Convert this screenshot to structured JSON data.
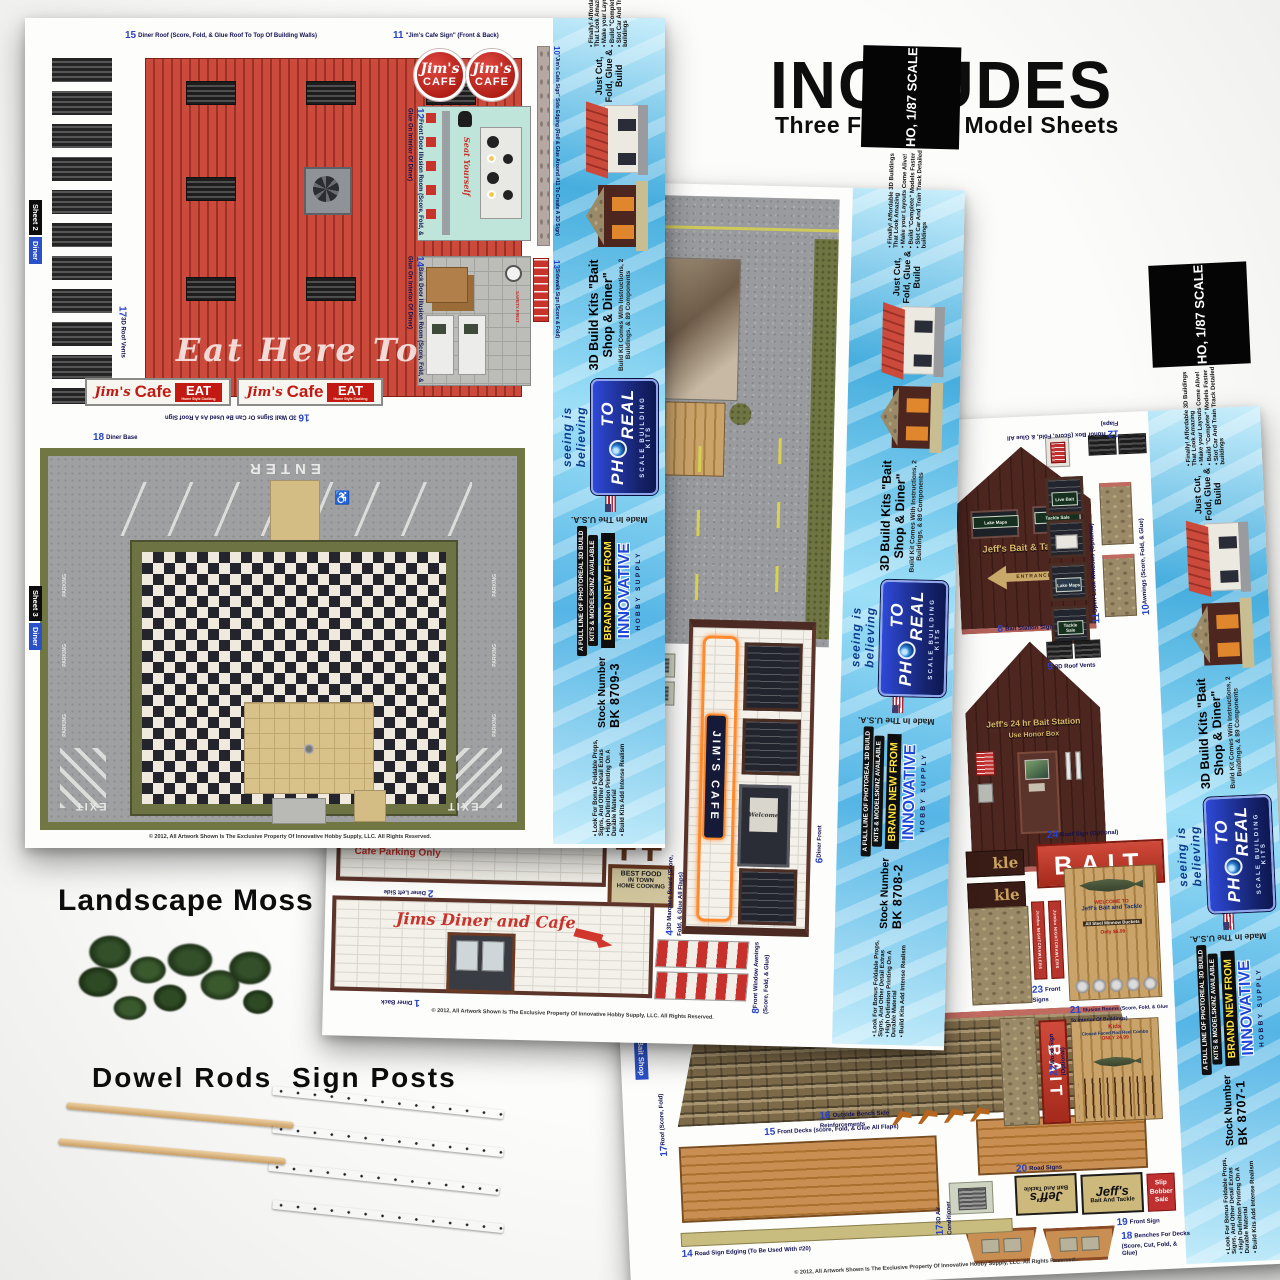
{
  "header": {
    "title": "INCLUDES",
    "subtitle": "Three Flexstock Model Sheets"
  },
  "extras": {
    "moss_label": "Landscape Moss",
    "dowel_label": "Dowel Rods",
    "signpost_label": "Sign Posts"
  },
  "copyright": "© 2012, All Artwork Shown Is The Exclusive Property Of Innovative Hobby Supply, LLC. All Rights Reserved.",
  "colors": {
    "spine_blue": "#55b5e5",
    "brand_yellow": "#ffe33c",
    "bait_red": "#c0392b",
    "roof_red": "#cb4a3b"
  },
  "spine": {
    "scale": "HO, 1/87 SCALE",
    "bullets_top": [
      "Finally! Affordable 3D Buildings That Look Amazing",
      "Make your Layouts Come Alive!",
      "Build \"Complete\" Models Faster",
      "Slot Car And Train Track Detailed buildings"
    ],
    "just_cut": "Just Cut, Fold, Glue & Build",
    "kit_title": "3D Build Kits  \"Bait Shop & Diner\"",
    "kit_sub": "Build Kit Comes With Instructions, 2 Buildings, & 89 Components",
    "logo_p1": "PH",
    "logo_p2": "TO REAL",
    "logo_sub": "SCALE BUILDING KITS",
    "tagline": "seeing is believing",
    "brand_new": "BRAND NEW FROM",
    "brand_name": "INNOVATIVE",
    "brand_sub": "HOBBY SUPPLY",
    "full_line1": "A FULL LINE OF PHOTOREAL 3D BUILD",
    "full_line2": "KITS & MODELSKINZ AVAILABLE",
    "made_in": "Made In The U.S.A.",
    "stock_label": "Stock Number",
    "bullets_bottom": [
      "Look For Bonus Foldable Props, Signs, And Other Detail Extras",
      "High Definition Printing On A Durable Material",
      "Build Kits Add Intense Realism"
    ]
  },
  "stock": {
    "left": "BK 8709-3",
    "middle": "BK 8708-2",
    "right": "BK 8707-1"
  },
  "left_sheet": {
    "tab_top_line1": "Sheet 2",
    "tab_top_line2": "Diner",
    "tab_bottom_line1": "Sheet 3",
    "tab_bottom_line2": "Diner",
    "p15_num": "15",
    "p15": "Diner Roof (Score, Fold, & Glue Roof To Top Of Building Walls)",
    "p11_num": "11",
    "p11": "\"Jim's Cafe Sign\" (Front & Back)",
    "p10_num": "10",
    "p10": "\"Jim's Cafe Sign\" Side Edging (Roll & Glue Around #11 To Create A 3D Sign)",
    "p12_num": "12",
    "p12": "Front Door Illusion Room (Score, Fold, & Glue On Interior Of Diner)",
    "p14_num": "14",
    "p14": "Back Door Illusion Room (Score, Fold, & Glue On Interior Of Diner)",
    "p13_num": "13",
    "p13": "Sidewalk Sign (Score & Fold)",
    "p17_num": "17",
    "p17": "3D Roof Vents",
    "p16_num": "16",
    "p16": "3D Wall Signs Or Can Be Used As A Roof Sign",
    "p18_num": "18",
    "p18": "Diner Base",
    "roof_script": "Eat Here Today",
    "cafe_sign_script": "Jim's",
    "cafe_sign_word": "CAFE",
    "wall_sign_script": "Jim's",
    "wall_sign_word": "Cafe",
    "wall_sign_eat": "EAT",
    "wall_sign_sub": "Home Style Cooking",
    "seat_yourself": "Seat Yourself",
    "safety": "SAFETY FIRST",
    "enter": "ENTER",
    "exit": "EXIT",
    "parking": "PARKING",
    "handicap": "♿"
  },
  "mid_sheet": {
    "p6_num": "6",
    "p6": "Diner Front",
    "p5_num": "5",
    "p5": "Air Conditioner (Score, Fold, & Glue Flaps)",
    "p4_num": "4",
    "p4": "3D Marquee Board (Score, Fold, & Glue All Flaps)",
    "p8_num": "8",
    "p8": "Front Window Awnings (Score, Fold, & Glue)",
    "p2_num": "2",
    "p2": "Diner Left Side",
    "p1_num": "1",
    "p1": "Diner Back",
    "neon_sign": "JIM'S CAFE",
    "welcome": "Welcome",
    "best1": "BEST FOOD",
    "best2": "IN TOWN",
    "best3": "HOME COOKING",
    "cafe_parking": "Cafe Parking Only",
    "back_script": "Jims Diner and Cafe"
  },
  "right_sheet": {
    "tab": "Bait Shop",
    "p12_num": "12",
    "p12": "Honor Box (Score, Fold, & Glue All Flaps)",
    "p11_num": "11",
    "p11": "Open-Look Windows (Optional)",
    "p10_num": "10",
    "p10": "Awnings (Score, Fold, & Glue)",
    "p9_num": "9",
    "p9": "3D Roof Vents",
    "p8_num": "8",
    "p8": "Bait Station Sign",
    "p24_num": "24",
    "p24": "Roof Sign (Optional)",
    "p23_num": "23",
    "p23": "Front Signs",
    "p22_num": "22",
    "p22": "Wood Sign (Optional)",
    "p21_num": "21",
    "p21": "Illusion Rooms (Score, Fold, & Glue To Interior Of Buildings)",
    "p20_num": "20",
    "p20": "Road Signs",
    "p19_num": "19",
    "p19": "Front Sign",
    "p18_num": "18",
    "p18": "Benches For Decks (Score, Cut, Fold, & Glue)",
    "p17r_num": "17",
    "p17r": "Roof (Score, Fold)",
    "p17a_num": "17",
    "p17a": "3D Air Conditioner",
    "p16_num": "16",
    "p16": "Outside Bench Side Reinforcements",
    "p15_num": "15",
    "p15": "Front Decks (score, Fold, & Glue All Flaps)",
    "p14_num": "14",
    "p14": "Road Sign Edging (To Be Used With #20)",
    "gable_sign": "Jeff's Bait & Tackle",
    "entrance": "ENTRANCE",
    "win_live": "Live Bait",
    "win_lake": "Lake Maps",
    "win_tackle": "Tackle Sale",
    "station1": "Jeff's 24 hr Bait Station",
    "station2": "Use Honor Box",
    "bait": "BAIT",
    "tackle_end": "kle",
    "jumbo_txt": "Jumbo NIGHTCRAWLERS",
    "int1_l1": "WELCOME TO",
    "int1_l2": "Jeff's Bait and Tackle",
    "int1_l3": "All Steel Minnow Buckets",
    "int1_l4": "Only $6.99",
    "int2_l1": "Kids",
    "int2_l2": "Closed Faced Rod Reel Combo",
    "int2_l3": "ONLY 24.99",
    "road_l1": "Jeff's",
    "road_l2": "Bait And Tackle",
    "slip1": "Slip",
    "slip2": "Bobber",
    "slip3": "Sale"
  }
}
